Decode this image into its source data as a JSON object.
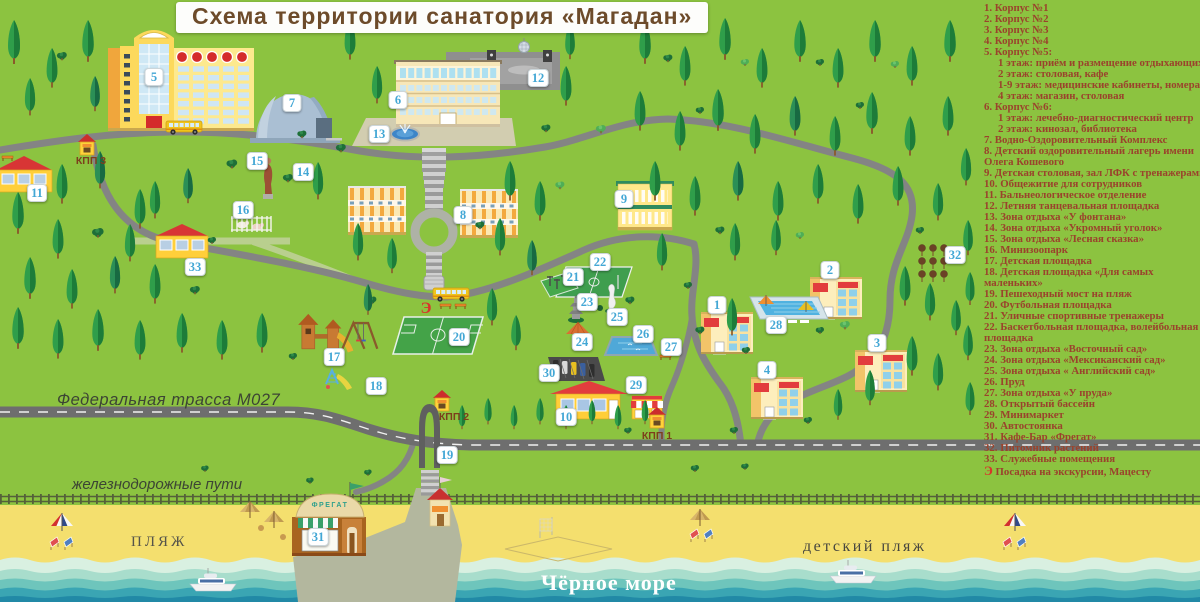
{
  "title": "Схема территории санатория «Магадан»",
  "colors": {
    "grass": "#8cc340",
    "sand": "#f4df6e",
    "sea_deep": "#2189a6",
    "badge_number": "#43a7d5",
    "legend_text": "#9a432c",
    "title_text": "#6d4b2a"
  },
  "legend": {
    "items": [
      {
        "num": "1.",
        "label": "Корпус №1"
      },
      {
        "num": "2.",
        "label": "Корпус №2"
      },
      {
        "num": "3.",
        "label": "Корпус №3"
      },
      {
        "num": "4.",
        "label": "Корпус №4"
      },
      {
        "num": "5.",
        "label": "Корпус №5:",
        "sub": [
          "1 этаж: приём и размещение отдыхающих",
          "2 этаж: столовая, кафе",
          "1-9 этаж: медицинские кабинеты, номера",
          "4 этаж: магазин, столовая"
        ]
      },
      {
        "num": "6.",
        "label": "Корпус №6:",
        "sub": [
          "1 этаж: лечебно-диагностический центр",
          "2 этаж: кинозал, библиотека"
        ]
      },
      {
        "num": "7.",
        "label": "Водно-Оздоровительный Комплекс"
      },
      {
        "num": "8.",
        "label": "Детский оздоровительный лагерь имени Олега Кошевого"
      },
      {
        "num": "9.",
        "label": "Детская столовая, зал ЛФК с тренажерами",
        "nw": true
      },
      {
        "num": "10.",
        "label": "Общежитие для сотрудников"
      },
      {
        "num": "11.",
        "label": "Бальнеологическое отделение"
      },
      {
        "num": "12.",
        "label": "Летняя танцевальная площадка"
      },
      {
        "num": "13.",
        "label": "Зона отдыха «У фонтана»"
      },
      {
        "num": "14.",
        "label": "Зона отдыха «Укромный уголок»"
      },
      {
        "num": "15.",
        "label": "Зона отдыха «Лесная сказка»"
      },
      {
        "num": "16.",
        "label": "Минизоопарк"
      },
      {
        "num": "17.",
        "label": "Детская площадка"
      },
      {
        "num": "18.",
        "label": "Детская площадка «Для самых маленьких»"
      },
      {
        "num": "19.",
        "label": "Пешеходный мост на пляж"
      },
      {
        "num": "20.",
        "label": "Футбольная площадка"
      },
      {
        "num": "21.",
        "label": "Уличные спортивные тренажеры"
      },
      {
        "num": "22.",
        "label": "Баскетбольная площадка, волейбольная площадка"
      },
      {
        "num": "23.",
        "label": "Зона отдыха «Восточный сад»"
      },
      {
        "num": "24.",
        "label": "Зона отдыха «Мексиканский сад»"
      },
      {
        "num": "25.",
        "label": "Зона отдыха « Английский сад»"
      },
      {
        "num": "26.",
        "label": "Пруд"
      },
      {
        "num": "27.",
        "label": "Зона отдыха «У пруда»"
      },
      {
        "num": "28.",
        "label": "Открытый бассейн"
      },
      {
        "num": "29.",
        "label": "Минимаркет"
      },
      {
        "num": "30.",
        "label": "Автостоянка"
      },
      {
        "num": "31.",
        "label": "Кафе-Бар «Фрегат»"
      },
      {
        "num": "32.",
        "label": "Питомник растений"
      },
      {
        "num": "33.",
        "label": "Служебные помещения"
      },
      {
        "num": "Э",
        "label": "Посадка на экскурсии, Мацесту",
        "special": true
      }
    ]
  },
  "map": {
    "markers": [
      {
        "label": "5",
        "x": 154,
        "y": 77
      },
      {
        "label": "7",
        "x": 292,
        "y": 103
      },
      {
        "label": "6",
        "x": 398,
        "y": 100
      },
      {
        "label": "13",
        "x": 379,
        "y": 134
      },
      {
        "label": "12",
        "x": 538,
        "y": 78
      },
      {
        "label": "11",
        "x": 37,
        "y": 193
      },
      {
        "label": "15",
        "x": 257,
        "y": 161
      },
      {
        "label": "14",
        "x": 303,
        "y": 172
      },
      {
        "label": "16",
        "x": 243,
        "y": 210
      },
      {
        "label": "33",
        "x": 195,
        "y": 267
      },
      {
        "label": "8",
        "x": 463,
        "y": 215
      },
      {
        "label": "9",
        "x": 624,
        "y": 199
      },
      {
        "label": "22",
        "x": 600,
        "y": 262
      },
      {
        "label": "21",
        "x": 573,
        "y": 277
      },
      {
        "label": "23",
        "x": 587,
        "y": 302
      },
      {
        "label": "25",
        "x": 617,
        "y": 317
      },
      {
        "label": "24",
        "x": 582,
        "y": 342
      },
      {
        "label": "26",
        "x": 643,
        "y": 334
      },
      {
        "label": "27",
        "x": 671,
        "y": 347
      },
      {
        "label": "1",
        "x": 717,
        "y": 305
      },
      {
        "label": "2",
        "x": 830,
        "y": 270
      },
      {
        "label": "28",
        "x": 776,
        "y": 325
      },
      {
        "label": "3",
        "x": 877,
        "y": 343
      },
      {
        "label": "4",
        "x": 767,
        "y": 370
      },
      {
        "label": "32",
        "x": 955,
        "y": 255
      },
      {
        "label": "17",
        "x": 334,
        "y": 357
      },
      {
        "label": "18",
        "x": 376,
        "y": 386
      },
      {
        "label": "20",
        "x": 459,
        "y": 337
      },
      {
        "label": "30",
        "x": 549,
        "y": 373
      },
      {
        "label": "10",
        "x": 566,
        "y": 417
      },
      {
        "label": "29",
        "x": 636,
        "y": 385
      },
      {
        "label": "19",
        "x": 447,
        "y": 455
      },
      {
        "label": "31",
        "x": 318,
        "y": 537
      }
    ],
    "checkpoints": [
      {
        "label": "КПП 3",
        "x": 91,
        "y": 161
      },
      {
        "label": "КПП 2",
        "x": 454,
        "y": 417
      },
      {
        "label": "КПП 1",
        "x": 657,
        "y": 436
      }
    ],
    "excursion_stop": {
      "label": "Э",
      "x": 426,
      "y": 309
    },
    "labels": {
      "federal_road": "Федеральная трасса М027",
      "railway": "железнодорожные пути",
      "beach": "ПЛЯЖ",
      "kids_beach": "детский пляж",
      "sea": "Чёрное море",
      "cafe_sign": "ФРЕГАТ"
    }
  }
}
